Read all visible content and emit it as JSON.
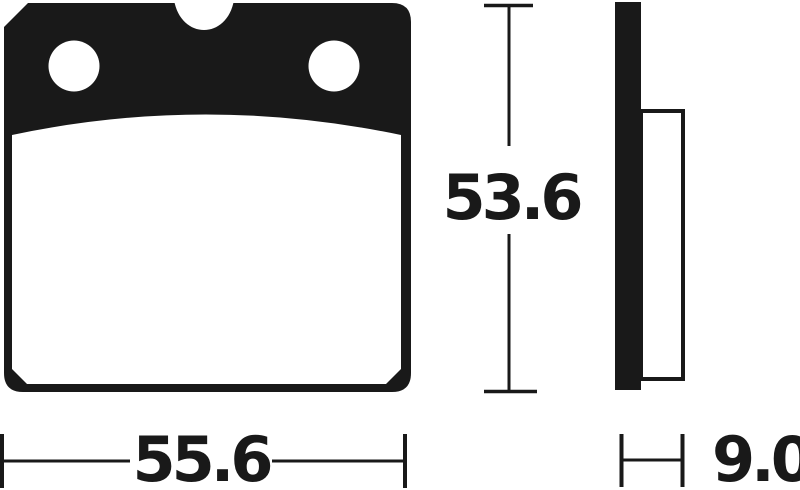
{
  "drawing": {
    "subject": "brake-pad-technical-drawing",
    "style": "black line art on white background",
    "colors": {
      "ink": "#191919",
      "background": "#ffffff"
    },
    "views": {
      "front": {
        "name": "front view of brake pad",
        "features": [
          "backing-plate (solid black upper band)",
          "mounting-hole-left",
          "mounting-hole-right",
          "top-center-notch",
          "friction-material (white area with thick outline, arched top edge)"
        ]
      },
      "side": {
        "name": "side profile of brake pad",
        "features": [
          "backing-plate-edge (solid black vertical bar)",
          "friction-material-profile (outlined white strip)"
        ]
      }
    },
    "dimensions": {
      "width": {
        "value": "55.6",
        "orientation": "horizontal",
        "measures": "pad width (front view)"
      },
      "height": {
        "value": "53.6",
        "orientation": "vertical",
        "measures": "pad height (front view)"
      },
      "thickness": {
        "value": "9.0",
        "orientation": "horizontal",
        "measures": "pad thickness (side view)"
      }
    }
  }
}
